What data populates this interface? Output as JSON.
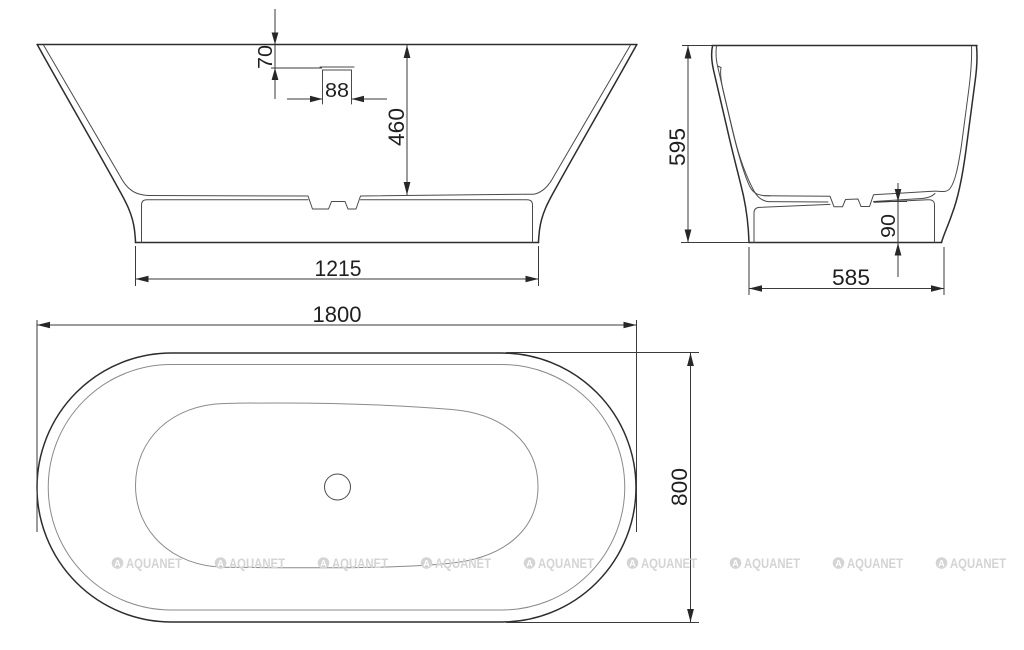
{
  "drawing": {
    "product": "freestanding-bathtub-technical-drawing",
    "units": "mm",
    "views": {
      "front": {
        "label": "front section view",
        "dims": {
          "rim_to_overflow": "70",
          "overflow_width": "88",
          "depth": "460",
          "base_length": "1215"
        }
      },
      "side": {
        "label": "end section view",
        "dims": {
          "height": "595",
          "base_width": "585",
          "plinth_height": "90"
        }
      },
      "top": {
        "label": "top plan view",
        "dims": {
          "length": "1800",
          "width": "800"
        }
      }
    }
  },
  "watermark": {
    "label": "AQUANET",
    "logo_letter": "A",
    "color": "#d4d4d4",
    "count": 9
  },
  "colors": {
    "background": "#ffffff",
    "outline": "#2d2d2d",
    "inner_line": "#8a8a8a",
    "dimension_text": "#1f1f1f"
  }
}
